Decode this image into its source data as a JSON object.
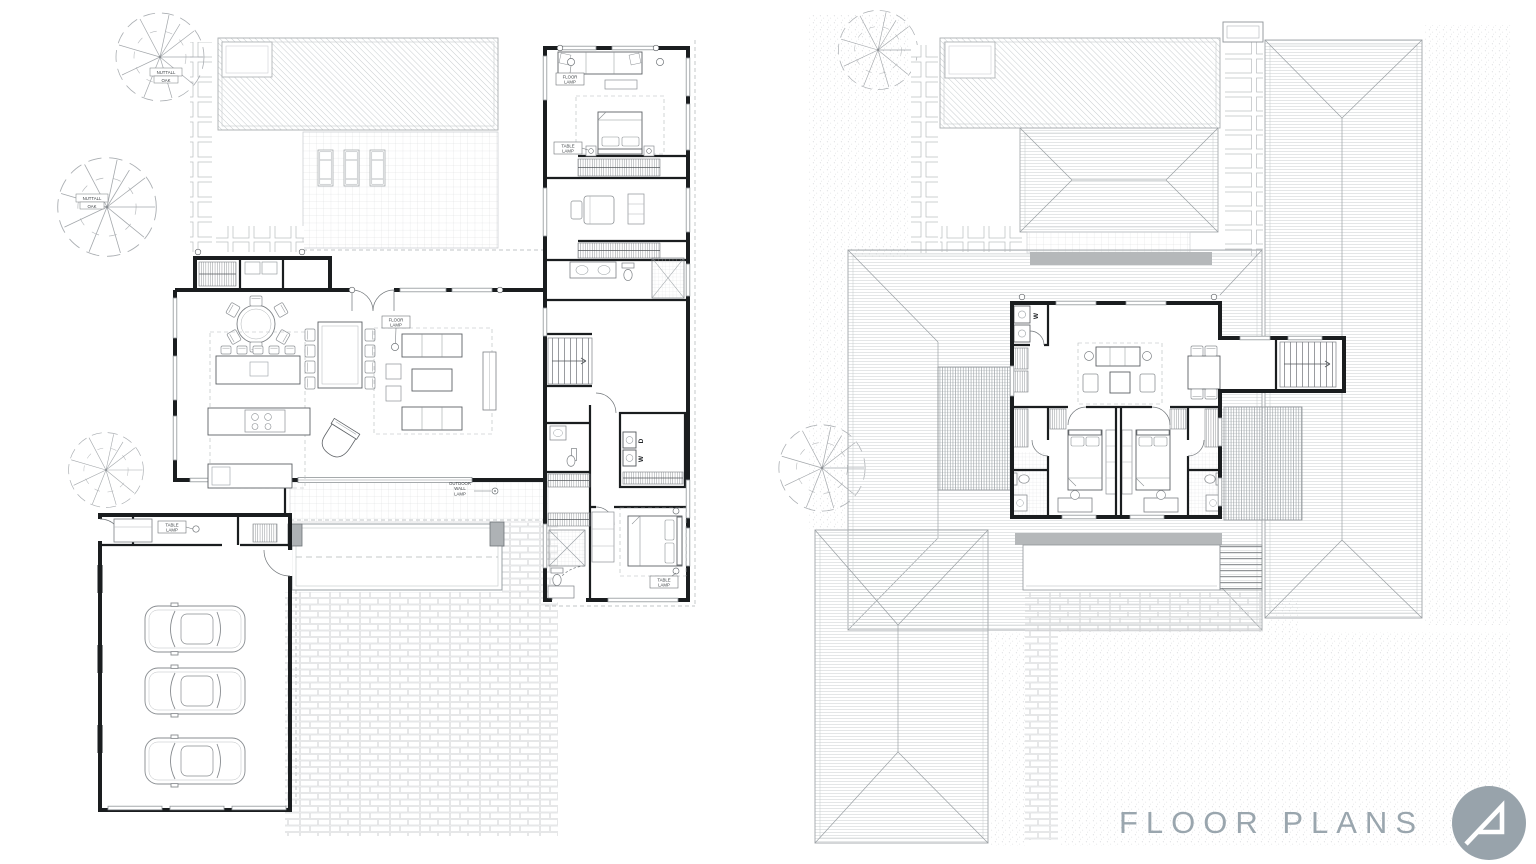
{
  "footer": {
    "title": "FLOOR PLANS"
  },
  "logo": {
    "icon": "architect-a-mark",
    "circle_color": "#98a3ab",
    "glyph_color": "#ffffff"
  },
  "colors": {
    "title_gray": "#9aa6ae",
    "wall_ink": "#1a1d1f",
    "light_line": "#c9cdd0",
    "balcony_gray": "#b5b8ba",
    "column_gray": "#aeb2b5"
  },
  "plans": {
    "first_floor": {
      "labels": {
        "tree": {
          "l1": "NUTTALL",
          "l2": "OAK"
        },
        "floor_lamp": {
          "l1": "FLOOR",
          "l2": "LAMP"
        },
        "table_lamp": {
          "l1": "TABLE",
          "l2": "LAMP"
        },
        "outdoor_wall_lamp": {
          "l1": "OUTDOOR",
          "l2": "WALL",
          "l3": "LAMP"
        },
        "washer": "W",
        "dryer": "D"
      }
    },
    "second_floor": {
      "labels": {
        "washer": "W"
      }
    }
  }
}
